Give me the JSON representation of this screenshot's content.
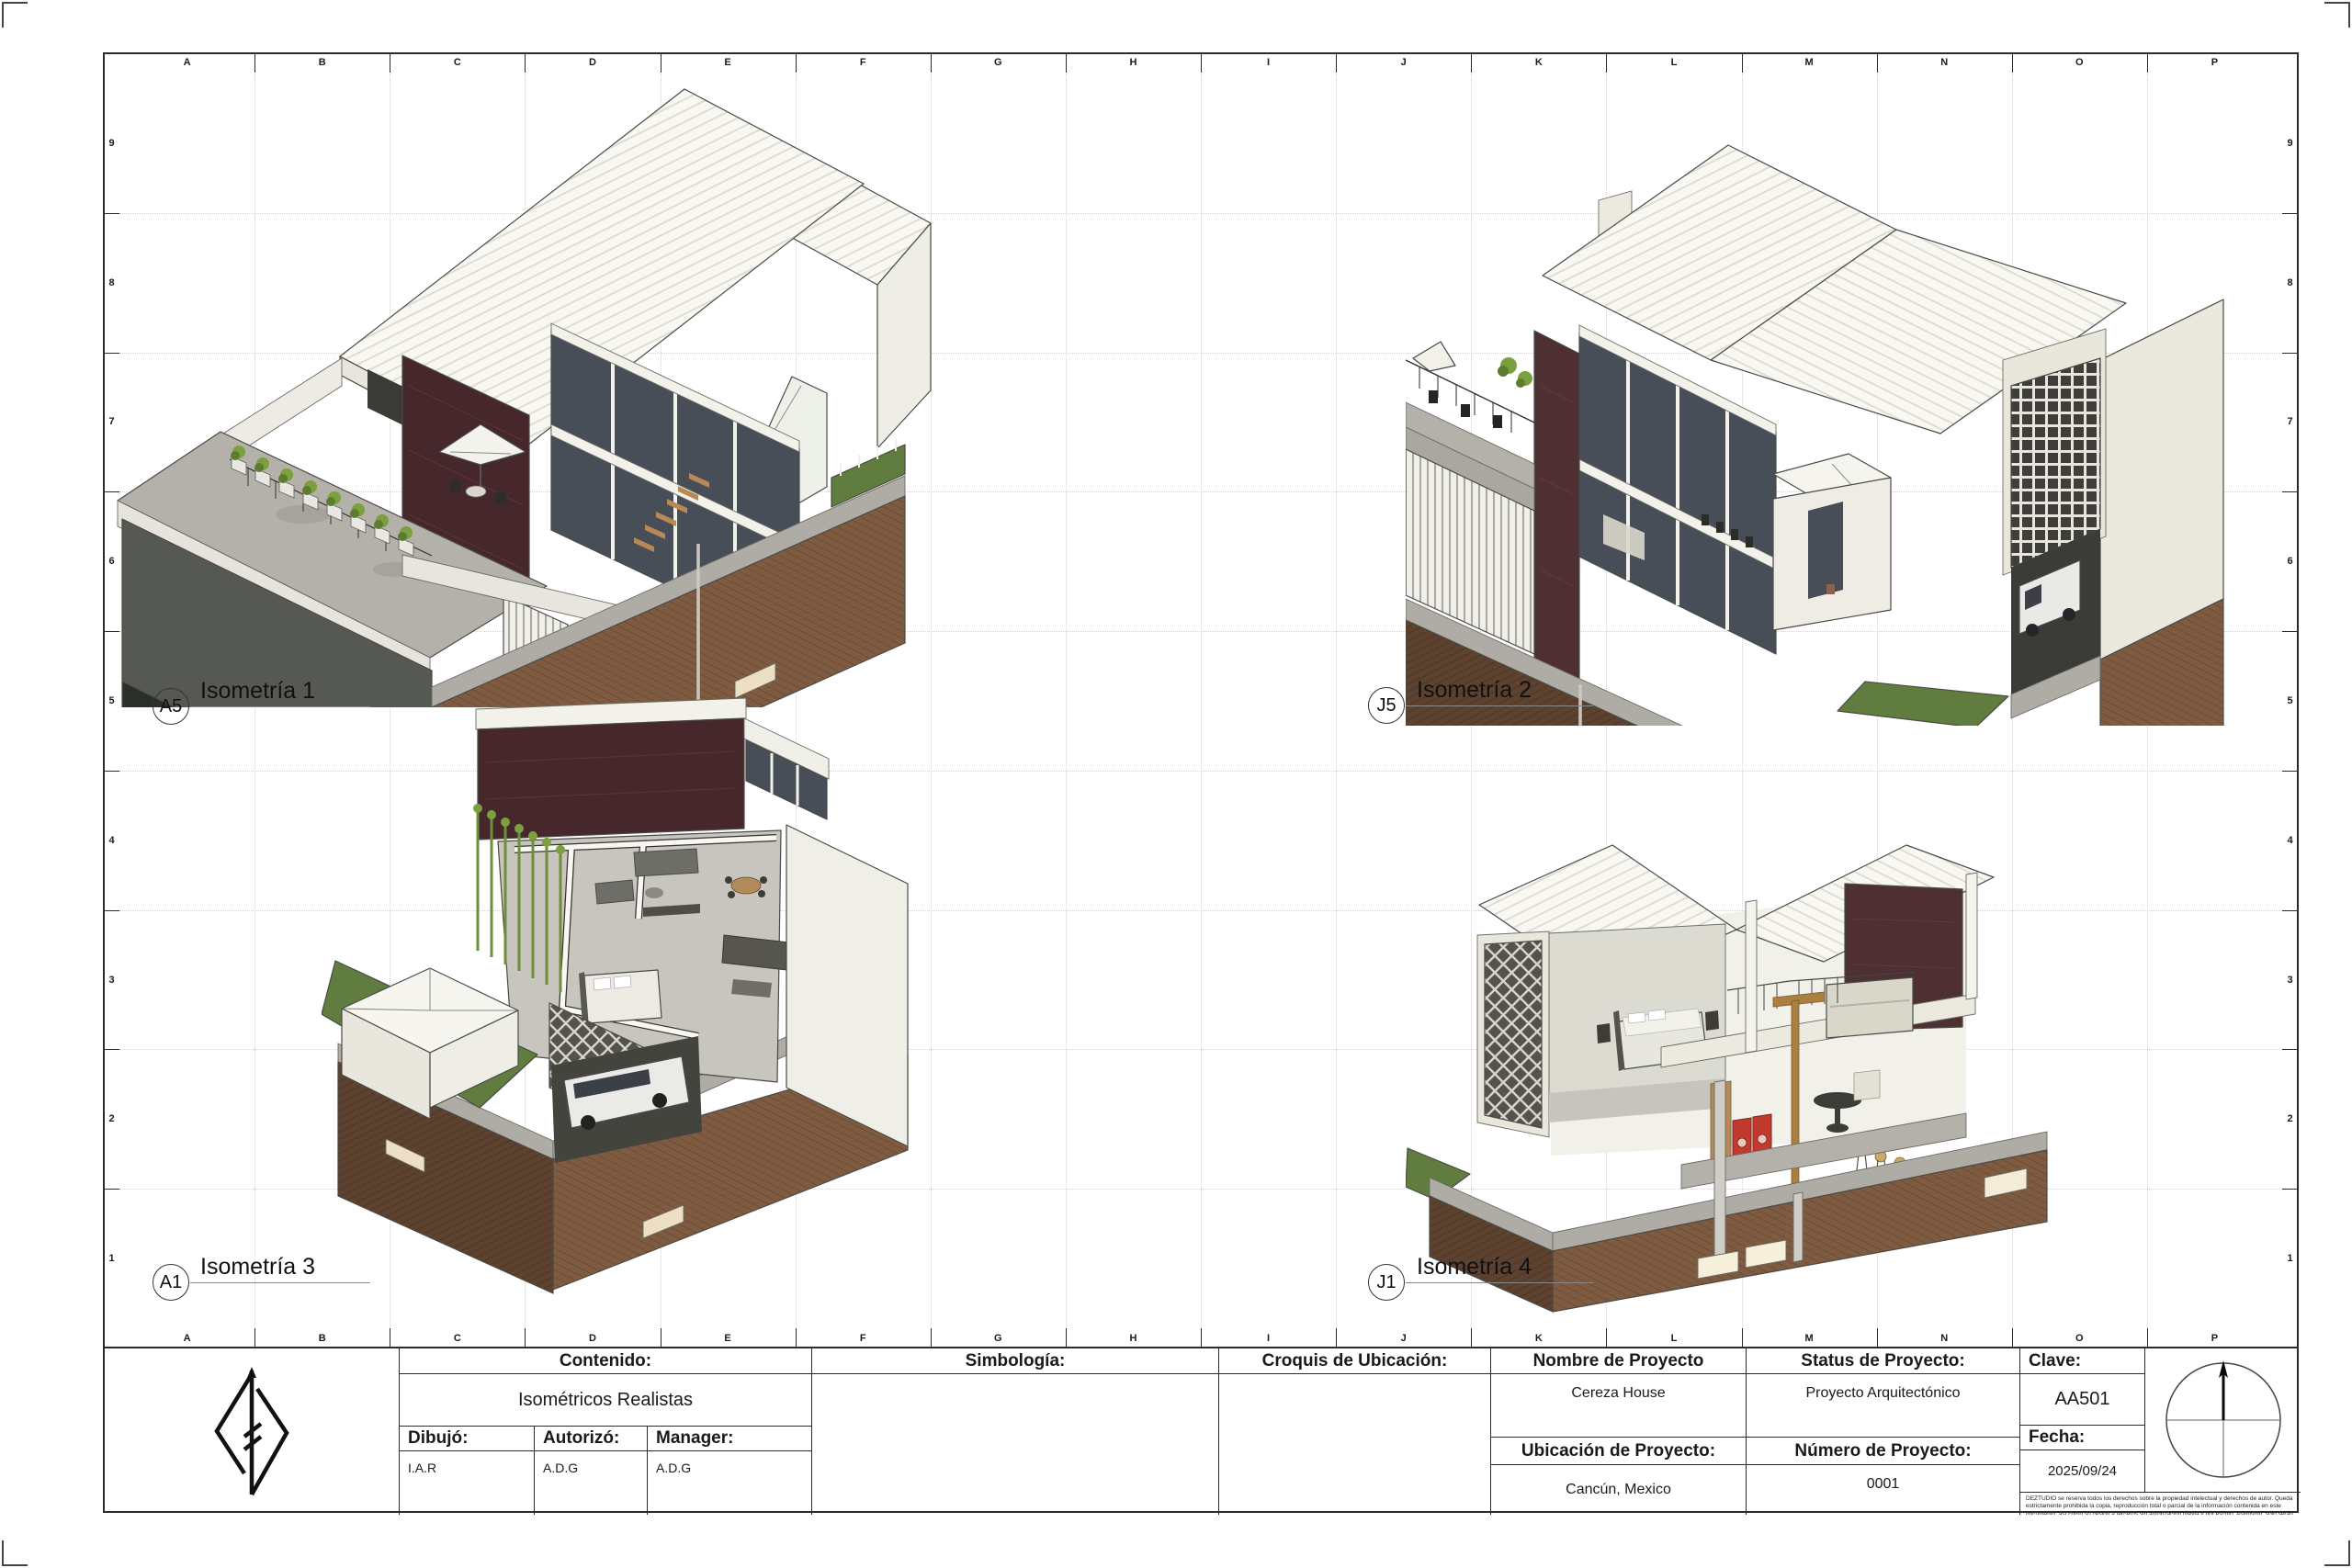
{
  "sheet": {
    "grid": {
      "columns": [
        "A",
        "B",
        "C",
        "D",
        "E",
        "F",
        "G",
        "H",
        "I",
        "J",
        "K",
        "L",
        "M",
        "N",
        "O",
        "P"
      ],
      "rows": [
        "9",
        "8",
        "7",
        "6",
        "5",
        "4",
        "3",
        "2",
        "1"
      ]
    },
    "views": [
      {
        "ref": "A5",
        "title": "Isometría 1"
      },
      {
        "ref": "J5",
        "title": "Isometría 2"
      },
      {
        "ref": "A1",
        "title": "Isometría 3"
      },
      {
        "ref": "J1",
        "title": "Isometría 4"
      }
    ],
    "title_block": {
      "contenido": {
        "label": "Contenido:",
        "value": "Isométricos Realistas"
      },
      "dibujo": {
        "label": "Dibujó:",
        "value": "I.A.R"
      },
      "autorizo": {
        "label": "Autorizó:",
        "value": "A.D.G"
      },
      "manager": {
        "label": "Manager:",
        "value": "A.D.G"
      },
      "simbologia": {
        "label": "Simbología:"
      },
      "croquis": {
        "label": "Croquis de Ubicación:"
      },
      "nombre": {
        "label": "Nombre de Proyecto",
        "value": "Cereza House"
      },
      "status": {
        "label": "Status de Proyecto:",
        "value": "Proyecto Arquitectónico"
      },
      "ubicacion": {
        "label": "Ubicación de Proyecto:",
        "value": "Cancún, Mexico"
      },
      "numero": {
        "label": "Número de Proyecto:",
        "value": "0001"
      },
      "clave": {
        "label": "Clave:",
        "value": "AA501"
      },
      "fecha": {
        "label": "Fecha:",
        "value": "2025/09/24"
      },
      "disclaimer": "DEZTUDIO se reserva todos los derechos sobre la propiedad intelectual y derechos de autor. Queda estrictamente prohibida la copia, reproducción total o parcial de la información contenida en este documento, así como su cesión a terceros sin autorización previa y por escrito. Asimismo, solo serán válidos para la construcción los planos que cuenten con la firma del director de proyectos. Cualquier obra realizada sin dicha autorización no será responsabilidad de DEZTUDIO."
    },
    "colors": {
      "line": "#2a2a2a",
      "brick": "#7f5c41",
      "brick_dark": "#5c422f",
      "maroon": "#4e3033",
      "green": "#607d3f",
      "roof_white": "#f8f7f2",
      "glass": "#474e58"
    }
  }
}
